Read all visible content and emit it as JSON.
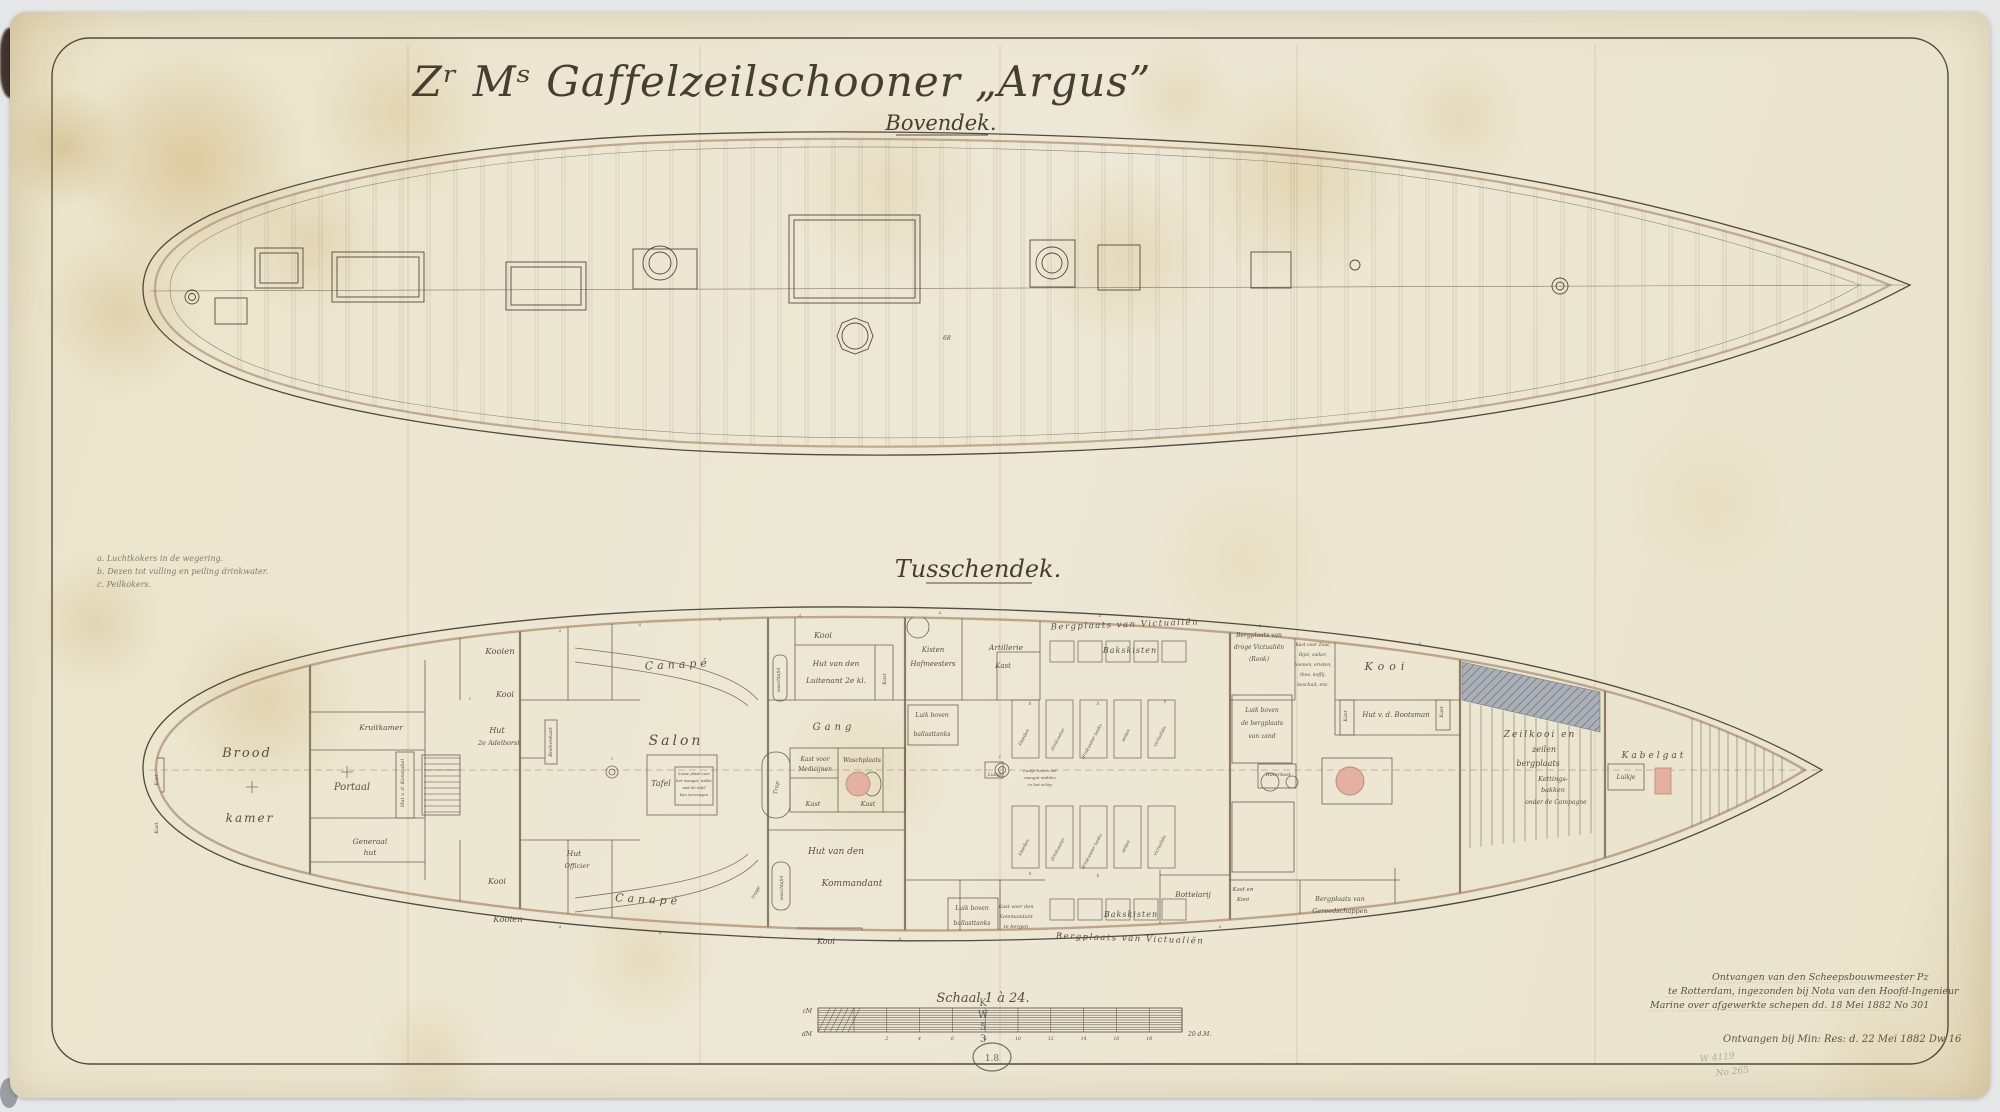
{
  "document": {
    "title": "Zʳ Mˢ Gaffelzeilschooner „Argus”",
    "subtitle": "Bovendek.",
    "middle_heading": "Tusschendek."
  },
  "colors": {
    "paper": "#ece6d0",
    "ink": "#54493c",
    "tan_rail": "#b29478",
    "pink_fixture": "#e3b0a1",
    "hatch_gray": "#a9aeb4",
    "stamp_teal": "#46564f"
  },
  "legend": {
    "labels": [
      {
        "t": "a. Luchtkokers in de wegering.",
        "x": 97,
        "y": 561,
        "s": 8,
        "a": "start"
      },
      {
        "t": "b. Dezen tot vulling en peiling drinkwater.",
        "x": 97,
        "y": 574,
        "s": 8,
        "a": "start"
      },
      {
        "t": "c. Peilkokers.",
        "x": 97,
        "y": 587,
        "s": 8,
        "a": "start"
      }
    ]
  },
  "topdeck": {
    "labels": [
      {
        "t": "68",
        "x": 947,
        "y": 340,
        "s": 6
      }
    ]
  },
  "tweendeck": {
    "labels": [
      {
        "t": "Brood",
        "x": 247,
        "y": 757,
        "s": 13,
        "sp": 2
      },
      {
        "t": "kamer",
        "x": 250,
        "y": 822,
        "s": 12,
        "sp": 2
      },
      {
        "t": "Portaal",
        "x": 352,
        "y": 790,
        "s": 10
      },
      {
        "t": "Kruitkamer",
        "x": 381,
        "y": 730,
        "s": 7.5
      },
      {
        "t": "Generaal",
        "x": 370,
        "y": 844,
        "s": 7.5
      },
      {
        "t": "hut",
        "x": 370,
        "y": 855,
        "s": 7.5
      },
      {
        "t": "Hut v. d. Konstabel",
        "x": 404,
        "y": 783,
        "s": 5,
        "r": -90
      },
      {
        "t": "Kast",
        "x": 158,
        "y": 780,
        "s": 5,
        "r": -90
      },
      {
        "t": "Kast",
        "x": 158,
        "y": 828,
        "s": 5,
        "r": -90
      },
      {
        "t": "Kooien",
        "x": 500,
        "y": 654,
        "s": 8.5
      },
      {
        "t": "Kooi",
        "x": 505,
        "y": 697,
        "s": 8
      },
      {
        "t": "Hut",
        "x": 497,
        "y": 733,
        "s": 8
      },
      {
        "t": "2e Adelborst",
        "x": 499,
        "y": 745,
        "s": 6.5
      },
      {
        "t": "Boekenkast",
        "x": 552,
        "y": 742,
        "s": 5,
        "r": -90
      },
      {
        "t": "Canapé",
        "x": 678,
        "y": 668,
        "s": 11,
        "sp": 4,
        "r": -3
      },
      {
        "t": "Canapé",
        "x": 648,
        "y": 903,
        "s": 11,
        "sp": 4,
        "r": 3
      },
      {
        "t": "Salon",
        "x": 676,
        "y": 745,
        "s": 14,
        "sp": 3
      },
      {
        "t": "Tafel",
        "x": 661,
        "y": 786,
        "s": 8
      },
      {
        "t": "Losse plaat over",
        "x": 694,
        "y": 775,
        "s": 3.8
      },
      {
        "t": "het mangat, welke",
        "x": 694,
        "y": 782,
        "s": 3.8
      },
      {
        "t": "met de tafel",
        "x": 694,
        "y": 789,
        "s": 3.8
      },
      {
        "t": "kan vervangen",
        "x": 694,
        "y": 796,
        "s": 3.8
      },
      {
        "t": "Kooi",
        "x": 823,
        "y": 638,
        "s": 8
      },
      {
        "t": "Hut van den",
        "x": 836,
        "y": 666,
        "s": 7.5
      },
      {
        "t": "Luitenant 2e kl.",
        "x": 836,
        "y": 683,
        "s": 7.5
      },
      {
        "t": "waschtafel",
        "x": 780,
        "y": 680,
        "s": 4.5,
        "r": -90
      },
      {
        "t": "Kast",
        "x": 886,
        "y": 679,
        "s": 5,
        "r": -90
      },
      {
        "t": "Gang",
        "x": 834,
        "y": 730,
        "s": 10,
        "sp": 4
      },
      {
        "t": "Trap",
        "x": 778,
        "y": 788,
        "s": 5.5,
        "r": -80
      },
      {
        "t": "Kast voor",
        "x": 815,
        "y": 761,
        "s": 6
      },
      {
        "t": "Medicijnen",
        "x": 815,
        "y": 771,
        "s": 6
      },
      {
        "t": "Waschplaats",
        "x": 862,
        "y": 762,
        "s": 6
      },
      {
        "t": "Kast",
        "x": 813,
        "y": 806,
        "s": 6.5
      },
      {
        "t": "Kast",
        "x": 868,
        "y": 806,
        "s": 6.5
      },
      {
        "t": "Hut van den",
        "x": 836,
        "y": 854,
        "s": 9
      },
      {
        "t": "Kommandant",
        "x": 852,
        "y": 886,
        "s": 9
      },
      {
        "t": "Kooi",
        "x": 826,
        "y": 944,
        "s": 8
      },
      {
        "t": "waschtafel",
        "x": 783,
        "y": 888,
        "s": 4.5,
        "r": -90
      },
      {
        "t": "trapje",
        "x": 757,
        "y": 893,
        "s": 4.5,
        "r": -60
      },
      {
        "t": "Kooi",
        "x": 497,
        "y": 884,
        "s": 8
      },
      {
        "t": "Kooien",
        "x": 508,
        "y": 922,
        "s": 8.5
      },
      {
        "t": "Hut",
        "x": 574,
        "y": 856,
        "s": 7.5
      },
      {
        "t": "Officier",
        "x": 577,
        "y": 868,
        "s": 6.5
      },
      {
        "t": "Kisten",
        "x": 933,
        "y": 652,
        "s": 7
      },
      {
        "t": "Hofmeesters",
        "x": 933,
        "y": 666,
        "s": 7
      },
      {
        "t": "Artillerie",
        "x": 1006,
        "y": 650,
        "s": 7.5
      },
      {
        "t": "Kast",
        "x": 1003,
        "y": 668,
        "s": 7
      },
      {
        "t": "Bakskisten",
        "x": 1130,
        "y": 653,
        "s": 8,
        "sp": 1
      },
      {
        "t": "Bakskisten",
        "x": 1131,
        "y": 917,
        "s": 8,
        "sp": 1
      },
      {
        "t": "Bergplaats van Victualiën",
        "x": 1125,
        "y": 627,
        "s": 8.5,
        "sp": 1.5,
        "r": -2
      },
      {
        "t": "Bergplaats van Victualiën",
        "x": 1130,
        "y": 941,
        "s": 8.5,
        "sp": 1.5,
        "r": 2
      },
      {
        "t": "Luik boven",
        "x": 932,
        "y": 717,
        "s": 6
      },
      {
        "t": "ballasttanks",
        "x": 932,
        "y": 736,
        "s": 6
      },
      {
        "t": "Luik boven",
        "x": 972,
        "y": 910,
        "s": 6
      },
      {
        "t": "ballasttanks",
        "x": 972,
        "y": 925,
        "s": 6
      },
      {
        "t": "Kast voor den",
        "x": 1016,
        "y": 908,
        "s": 5
      },
      {
        "t": "Kommandant",
        "x": 1016,
        "y": 918,
        "s": 5
      },
      {
        "t": "te bergen",
        "x": 1016,
        "y": 928,
        "s": 5
      },
      {
        "t": "kleeden",
        "x": 1025,
        "y": 738,
        "s": 4.5,
        "r": -62
      },
      {
        "t": "drinkwater",
        "x": 1059,
        "y": 740,
        "s": 4.5,
        "r": -62
      },
      {
        "t": "drinkwater tanks",
        "x": 1093,
        "y": 742,
        "s": 4.5,
        "r": -62
      },
      {
        "t": "zeilen",
        "x": 1127,
        "y": 736,
        "s": 4.5,
        "r": -62
      },
      {
        "t": "victualiën",
        "x": 1161,
        "y": 737,
        "s": 4.5,
        "r": -62
      },
      {
        "t": "kleeden",
        "x": 1025,
        "y": 848,
        "s": 4.5,
        "r": -62
      },
      {
        "t": "drinkwater",
        "x": 1059,
        "y": 850,
        "s": 4.5,
        "r": -62
      },
      {
        "t": "drinkwater tanks",
        "x": 1093,
        "y": 852,
        "s": 4.5,
        "r": -62
      },
      {
        "t": "zeilen",
        "x": 1127,
        "y": 847,
        "s": 4.5,
        "r": -62
      },
      {
        "t": "victualiën",
        "x": 1161,
        "y": 846,
        "s": 4.5,
        "r": -62
      },
      {
        "t": "Luikje",
        "x": 995,
        "y": 776,
        "s": 4.5
      },
      {
        "t": "Luikje boven het",
        "x": 1040,
        "y": 772,
        "s": 4
      },
      {
        "t": "mangat midden",
        "x": 1040,
        "y": 779,
        "s": 4
      },
      {
        "t": "in het schip",
        "x": 1040,
        "y": 786,
        "s": 4
      },
      {
        "t": "Bergplaats van",
        "x": 1259,
        "y": 637,
        "s": 6
      },
      {
        "t": "droge Victualiën",
        "x": 1259,
        "y": 649,
        "s": 6
      },
      {
        "t": "(Rook)",
        "x": 1259,
        "y": 661,
        "s": 6
      },
      {
        "t": "Kast voor Zout,",
        "x": 1313,
        "y": 646,
        "s": 4.5
      },
      {
        "t": "Rijst, suiker,",
        "x": 1313,
        "y": 656,
        "s": 4.5
      },
      {
        "t": "boonen, erwten,",
        "x": 1313,
        "y": 666,
        "s": 4.5
      },
      {
        "t": "thee, koffij,",
        "x": 1313,
        "y": 676,
        "s": 4.5
      },
      {
        "t": "beschuit, enz.",
        "x": 1313,
        "y": 686,
        "s": 4.5
      },
      {
        "t": "Kooi",
        "x": 1387,
        "y": 670,
        "s": 11,
        "sp": 5
      },
      {
        "t": "Hut v. d. Bootsman",
        "x": 1396,
        "y": 717,
        "s": 7
      },
      {
        "t": "Kast",
        "x": 1347,
        "y": 716,
        "s": 5,
        "r": -90
      },
      {
        "t": "Kast",
        "x": 1443,
        "y": 712,
        "s": 5,
        "r": -90
      },
      {
        "t": "Luik boven",
        "x": 1262,
        "y": 712,
        "s": 6
      },
      {
        "t": "de bergplaats",
        "x": 1262,
        "y": 725,
        "s": 6
      },
      {
        "t": "van zand",
        "x": 1262,
        "y": 738,
        "s": 6
      },
      {
        "t": "Waterkast",
        "x": 1278,
        "y": 776,
        "s": 5
      },
      {
        "t": "Bottelarij",
        "x": 1193,
        "y": 897,
        "s": 7.5
      },
      {
        "t": "Kast en",
        "x": 1243,
        "y": 891,
        "s": 5.5
      },
      {
        "t": "Kooi",
        "x": 1243,
        "y": 901,
        "s": 5.5
      },
      {
        "t": "Bergplaats van",
        "x": 1340,
        "y": 901,
        "s": 6.5
      },
      {
        "t": "Gereedschappen",
        "x": 1340,
        "y": 913,
        "s": 6.5
      },
      {
        "t": "Zeilkooi en",
        "x": 1540,
        "y": 737,
        "s": 9,
        "sp": 2
      },
      {
        "t": "zeilen",
        "x": 1544,
        "y": 752,
        "s": 8
      },
      {
        "t": "bergplaats",
        "x": 1538,
        "y": 766,
        "s": 8
      },
      {
        "t": "Kettings-",
        "x": 1553,
        "y": 781,
        "s": 6.5
      },
      {
        "t": "bakken",
        "x": 1553,
        "y": 792,
        "s": 6.5
      },
      {
        "t": "onder de Campagne",
        "x": 1556,
        "y": 804,
        "s": 6
      },
      {
        "t": "Kabelgat",
        "x": 1654,
        "y": 758,
        "s": 9,
        "sp": 3
      },
      {
        "t": "Luikje",
        "x": 1626,
        "y": 779,
        "s": 6
      }
    ],
    "marks": [
      {
        "t": "a",
        "x": 560,
        "y": 632,
        "s": 4.5
      },
      {
        "t": "a",
        "x": 640,
        "y": 626,
        "s": 4.5
      },
      {
        "t": "a",
        "x": 720,
        "y": 621,
        "s": 4.5
      },
      {
        "t": "a",
        "x": 800,
        "y": 617,
        "s": 4.5
      },
      {
        "t": "a",
        "x": 940,
        "y": 614,
        "s": 4.5
      },
      {
        "t": "a",
        "x": 1100,
        "y": 617,
        "s": 4.5
      },
      {
        "t": "a",
        "x": 1260,
        "y": 627,
        "s": 4.5
      },
      {
        "t": "a",
        "x": 1420,
        "y": 645,
        "s": 4.5
      },
      {
        "t": "a",
        "x": 560,
        "y": 928,
        "s": 4.5
      },
      {
        "t": "a",
        "x": 660,
        "y": 934,
        "s": 4.5
      },
      {
        "t": "a",
        "x": 760,
        "y": 938,
        "s": 4.5
      },
      {
        "t": "a",
        "x": 900,
        "y": 940,
        "s": 4.5
      },
      {
        "t": "a",
        "x": 1060,
        "y": 936,
        "s": 4.5
      },
      {
        "t": "a",
        "x": 1220,
        "y": 928,
        "s": 4.5
      },
      {
        "t": "b",
        "x": 1030,
        "y": 705,
        "s": 4.5
      },
      {
        "t": "b",
        "x": 1098,
        "y": 705,
        "s": 4.5
      },
      {
        "t": "b",
        "x": 1165,
        "y": 703,
        "s": 4.5
      },
      {
        "t": "b",
        "x": 1030,
        "y": 875,
        "s": 4.5
      },
      {
        "t": "b",
        "x": 1098,
        "y": 877,
        "s": 4.5
      },
      {
        "t": "c",
        "x": 470,
        "y": 700,
        "s": 4.5
      },
      {
        "t": "c",
        "x": 612,
        "y": 760,
        "s": 4.5
      },
      {
        "t": "c",
        "x": 1000,
        "y": 758,
        "s": 4.5
      }
    ]
  },
  "scale": {
    "title": "Schaal 1 à 24.",
    "unit_top_left": "cM",
    "unit_bottom_left": "dM",
    "tick_labels": [
      "2",
      "4",
      "6",
      "8",
      "10",
      "12",
      "14",
      "16",
      "18"
    ],
    "right_label": "20 d.M."
  },
  "stamps": {
    "letters": [
      {
        "t": "K",
        "x": 983,
        "y": 1006,
        "s": 10
      },
      {
        "t": "W",
        "x": 983,
        "y": 1018,
        "s": 10
      },
      {
        "t": "5",
        "x": 983,
        "y": 1030,
        "s": 10
      },
      {
        "t": "3",
        "x": 983,
        "y": 1042,
        "s": 10
      }
    ],
    "circle_mark": "1.8"
  },
  "notes": {
    "labels": [
      {
        "t": "Ontvangen van den Scheepsbouwmeester Pz",
        "x": 1712,
        "y": 980,
        "s": 9.5,
        "a": "start"
      },
      {
        "t": "te Rotterdam, ingezonden bij Nota van den Hoofd-Ingenieur",
        "x": 1668,
        "y": 994,
        "s": 9.5,
        "a": "start"
      },
      {
        "t": "Marine over afgewerkte schepen dd. 18 Mei 1882 No 301",
        "x": 1650,
        "y": 1008,
        "s": 9.5,
        "a": "start"
      },
      {
        "t": "Ontvangen bij Min: Res: d. 22 Mei 1882 Dw 16",
        "x": 1723,
        "y": 1042,
        "s": 10,
        "a": "start"
      }
    ],
    "pencil": [
      {
        "t": "W 4119",
        "x": 1700,
        "y": 1062,
        "s": 9,
        "r": -6,
        "a": "start"
      },
      {
        "t": "No 265",
        "x": 1716,
        "y": 1076,
        "s": 9,
        "r": -6,
        "a": "start"
      }
    ]
  }
}
